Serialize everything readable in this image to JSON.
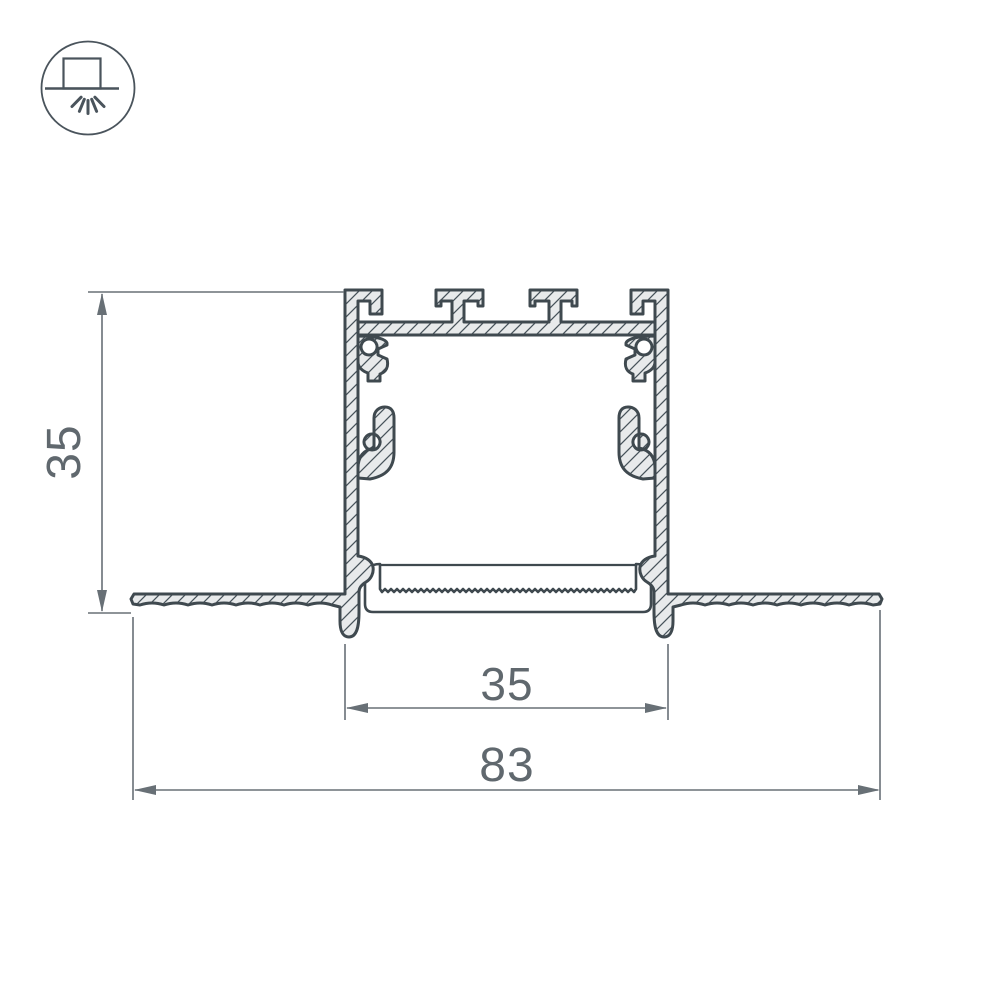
{
  "page": {
    "type": "technical-drawing",
    "background": "#ffffff"
  },
  "icon": {
    "name": "recessed-mount-luminaire",
    "description": "box over ceiling line with downward light rays"
  },
  "dimensions": [
    {
      "id": "profile-height",
      "value": "35",
      "orientation": "vertical"
    },
    {
      "id": "recess-width",
      "value": "35",
      "orientation": "horizontal"
    },
    {
      "id": "overall-width",
      "value": "83",
      "orientation": "horizontal"
    }
  ],
  "colors": {
    "outline": "#3f494f",
    "metal_fill": "#e8eaeb",
    "hatch_line": "#47525a",
    "dimension_line": "#687076",
    "dimension_text": "#60686e",
    "icon_stroke": "#4a545c",
    "background": "#ffffff"
  }
}
